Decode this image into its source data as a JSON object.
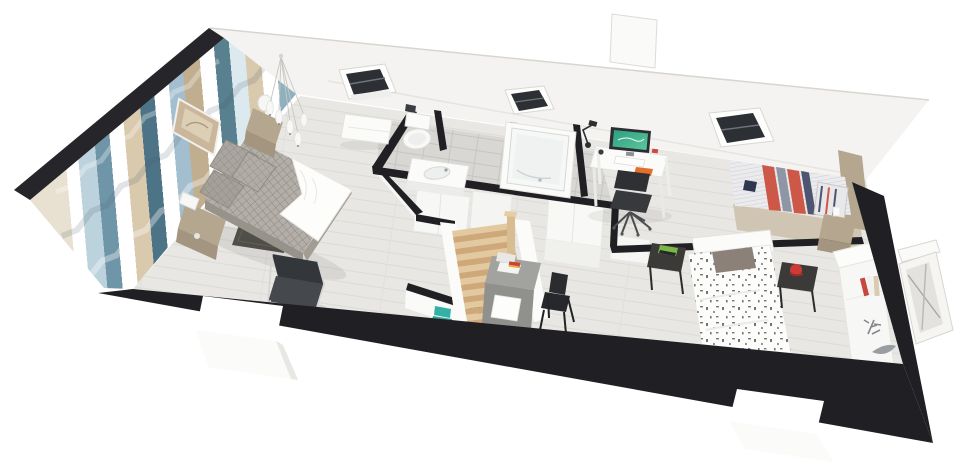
{
  "scene": {
    "title": "3D cutaway floor plan of an attic storey",
    "style": "isometric architectural render, walls cut in black section",
    "background": "#ffffff"
  },
  "palette": {
    "wall_cut_black": "#202024",
    "roof_white": "#f4f3f1",
    "floor_wood": "#e8e7e3",
    "bathroom_tile": "#d8d7d3",
    "stair_wood": "#e3c9a0",
    "taupe_furniture": "#b5a78f",
    "accent_teal_stool": "#2fa39a",
    "accent_red_stripe": "#cd5847",
    "accent_navy_stripe": "#4d5571",
    "accent_orange_notebook": "#e2702d",
    "accent_kiwi_wall": "#d8d668",
    "monitor_screen_green": "#2e9e82",
    "duvet_gray": "#b3afa8",
    "wallpaper_stripes": [
      "#e8e0d0",
      "#ffffff",
      "#bcd3de",
      "#6f96a8",
      "#d9c9ad",
      "#4d7486",
      "#a3bfcf",
      "#c0ae8e",
      "#58808f",
      "#dce9ef",
      "#8fb0bf"
    ]
  },
  "rooms": [
    {
      "id": "master-bedroom",
      "label": "Master bedroom with chevron wallpaper, double bed, nightstands, pendant lights, armchair"
    },
    {
      "id": "bathroom",
      "label": "Bathroom with toilet, washbasin, bathtub and bench"
    },
    {
      "id": "landing",
      "label": "Landing with wooden staircase, teal stool and white closets"
    },
    {
      "id": "office-nook",
      "label": "Office nook with white desk, monitor and black office chair"
    },
    {
      "id": "bedroom-striped",
      "label": "Bedroom with red and navy striped single bed, taupe nightstand and kiwi accent wall"
    },
    {
      "id": "bedroom-icons",
      "label": "Bedroom with icon-print single bed, metal side tables, gray desk and white dresser"
    }
  ],
  "exterior": {
    "label": "White roof plane with three skylights, chimney, black section walls, window openings and leaning mirror frame",
    "skylight_count": "3"
  }
}
